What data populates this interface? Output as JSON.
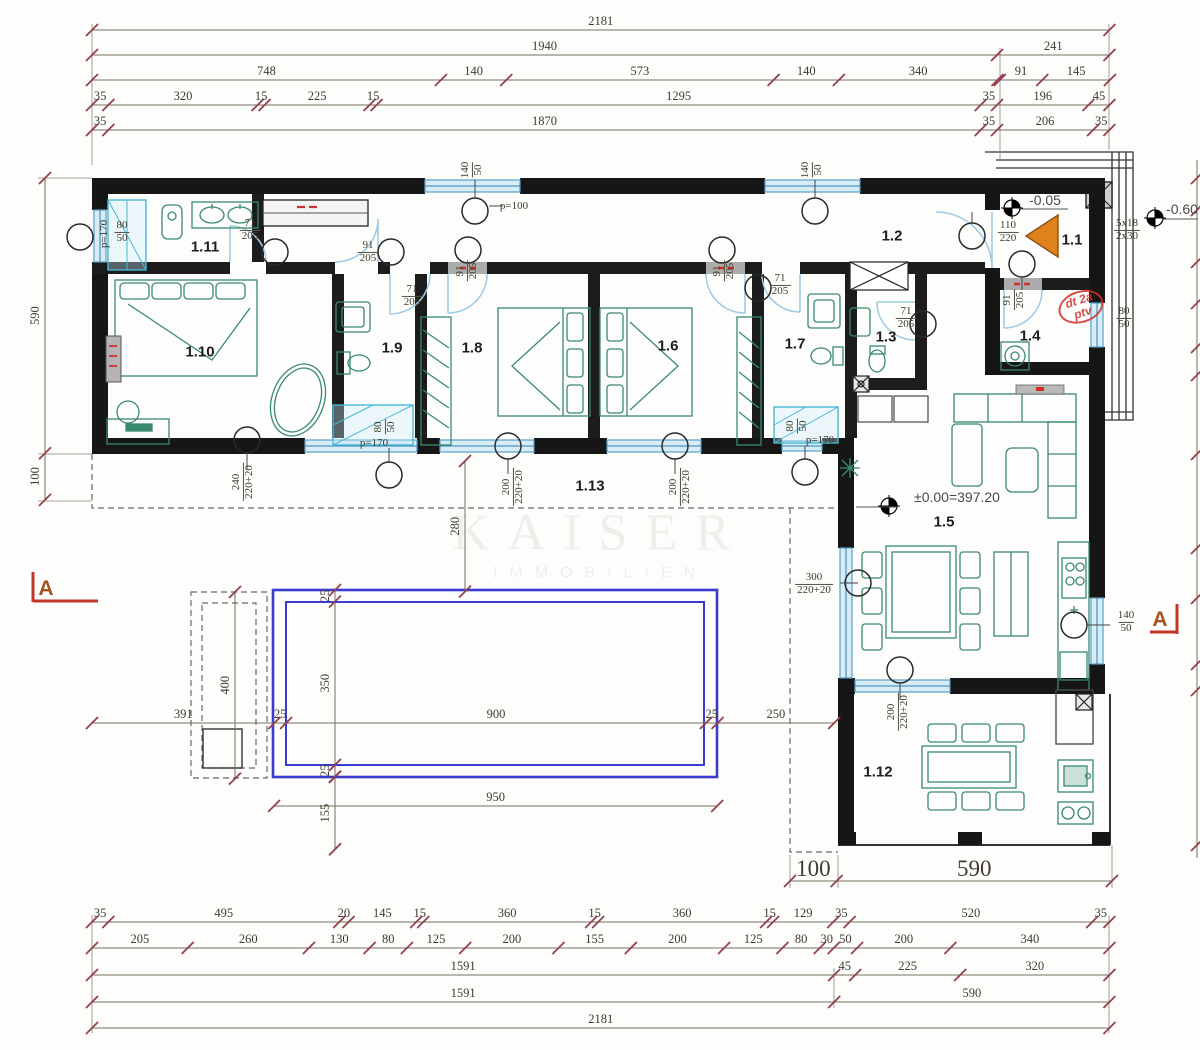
{
  "watermark": {
    "line1": "KAISER",
    "line2": "IMMOBILIEN"
  },
  "scale_px_per_cm": 0.4665,
  "colors": {
    "walls": "#161616",
    "dim_line": "#75705c",
    "dim_tick": "#93404a",
    "dim_text": "#3f3b2d",
    "window": "#5aa0c8",
    "window_fill": "#d6ecf7",
    "door_arc": "#9fcbe4",
    "furniture": "#3a8a6e",
    "pool": "#3b3bd1",
    "red_note": "#d03028",
    "orange_arrow": "#e0821c"
  },
  "rooms": [
    {
      "label": "1.1",
      "x": 1072,
      "y": 240
    },
    {
      "label": "1.2",
      "x": 892,
      "y": 236
    },
    {
      "label": "1.3",
      "x": 886,
      "y": 337
    },
    {
      "label": "1.4",
      "x": 1030,
      "y": 336
    },
    {
      "label": "1.5",
      "x": 944,
      "y": 522
    },
    {
      "label": "1.6",
      "x": 668,
      "y": 346
    },
    {
      "label": "1.7",
      "x": 795,
      "y": 344
    },
    {
      "label": "1.8",
      "x": 472,
      "y": 348
    },
    {
      "label": "1.9",
      "x": 392,
      "y": 348
    },
    {
      "label": "1.10",
      "x": 200,
      "y": 352
    },
    {
      "label": "1.11",
      "x": 205,
      "y": 247
    },
    {
      "label": "1.12",
      "x": 878,
      "y": 772
    },
    {
      "label": "1.13",
      "x": 590,
      "y": 486
    }
  ],
  "door_window_tags": [
    {
      "top": "71",
      "bottom": "205",
      "x": 250,
      "y": 230,
      "rot": 0
    },
    {
      "top": "91",
      "bottom": "205",
      "x": 368,
      "y": 252,
      "rot": 0
    },
    {
      "top": "71",
      "bottom": "205",
      "x": 412,
      "y": 296,
      "rot": 0
    },
    {
      "top": "91",
      "bottom": "205",
      "x": 467,
      "y": 271,
      "rot": -90
    },
    {
      "top": "91",
      "bottom": "205",
      "x": 724,
      "y": 271,
      "rot": -90
    },
    {
      "top": "71",
      "bottom": "205",
      "x": 780,
      "y": 285,
      "rot": 0
    },
    {
      "top": "71",
      "bottom": "205",
      "x": 906,
      "y": 318,
      "rot": 0
    },
    {
      "top": "91",
      "bottom": "205",
      "x": 1014,
      "y": 300,
      "rot": -90
    },
    {
      "top": "110",
      "bottom": "220",
      "x": 1008,
      "y": 232,
      "rot": 0
    },
    {
      "top": "80",
      "bottom": "50",
      "x": 122,
      "y": 232,
      "rot": 0
    },
    {
      "top": "140",
      "bottom": "50",
      "x": 472,
      "y": 170,
      "rot": -90
    },
    {
      "top": "140",
      "bottom": "50",
      "x": 812,
      "y": 170,
      "rot": -90
    },
    {
      "top": "80",
      "bottom": "50",
      "x": 385,
      "y": 427,
      "rot": -90
    },
    {
      "top": "80",
      "bottom": "50",
      "x": 797,
      "y": 426,
      "rot": -90
    },
    {
      "top": "240",
      "bottom": "220+20",
      "x": 243,
      "y": 482,
      "rot": -90
    },
    {
      "top": "200",
      "bottom": "220+20",
      "x": 513,
      "y": 487,
      "rot": -90
    },
    {
      "top": "200",
      "bottom": "220+20",
      "x": 680,
      "y": 487,
      "rot": -90
    },
    {
      "top": "200",
      "bottom": "220+20",
      "x": 898,
      "y": 712,
      "rot": -90
    },
    {
      "top": "300",
      "bottom": "220+20",
      "x": 814,
      "y": 584,
      "rot": 0
    },
    {
      "top": "80",
      "bottom": "50",
      "x": 1124,
      "y": 318,
      "rot": 0
    },
    {
      "top": "140",
      "bottom": "50",
      "x": 1126,
      "y": 622,
      "rot": 0
    },
    {
      "top": "5x18",
      "bottom": "2x30",
      "x": 1127,
      "y": 230,
      "rot": 0
    }
  ],
  "notes": [
    {
      "text": "p=100",
      "x": 514,
      "y": 206,
      "rot": 0
    },
    {
      "text": "p=170",
      "x": 104,
      "y": 234,
      "rot": -90
    },
    {
      "text": "p=170",
      "x": 374,
      "y": 443,
      "rot": 0
    },
    {
      "text": "p=170",
      "x": 820,
      "y": 440,
      "rot": 0
    }
  ],
  "levels": [
    {
      "text": "-0.05",
      "x": 1045,
      "y": 200
    },
    {
      "text": "-0.60",
      "x": 1182,
      "y": 209
    },
    {
      "text": "±0.00=397.20",
      "x": 957,
      "y": 497
    }
  ],
  "red_stamp": {
    "line1": "dt 2a",
    "line2": "ptv"
  },
  "section_markers": [
    {
      "label": "A",
      "x": 46,
      "y": 589
    },
    {
      "label": "A",
      "x": 1160,
      "y": 620
    }
  ],
  "dim_chains": [
    {
      "id": "top-1",
      "orient": "h",
      "x": 92,
      "y": 30,
      "fs": 12.5,
      "segments": [
        {
          "cm": 2181,
          "label": "2181"
        }
      ]
    },
    {
      "id": "top-2",
      "orient": "h",
      "x": 92,
      "y": 55,
      "fs": 12.5,
      "segments": [
        {
          "cm": 1940,
          "label": "1940"
        },
        {
          "cm": 241,
          "label": "241"
        }
      ]
    },
    {
      "id": "top-3",
      "orient": "h",
      "x": 92,
      "y": 80,
      "fs": 12.5,
      "segments": [
        {
          "cm": 748,
          "label": "748"
        },
        {
          "cm": 140,
          "label": "140"
        },
        {
          "cm": 573,
          "label": "573"
        },
        {
          "cm": 140,
          "label": "140"
        },
        {
          "cm": 340,
          "label": "340"
        },
        {
          "cm": 5,
          "label": ""
        },
        {
          "cm": 91,
          "label": "91"
        },
        {
          "cm": 145,
          "label": "145"
        }
      ]
    },
    {
      "id": "top-4",
      "orient": "h",
      "x": 92,
      "y": 105,
      "fs": 12.5,
      "segments": [
        {
          "cm": 35,
          "label": "35"
        },
        {
          "cm": 320,
          "label": "320"
        },
        {
          "cm": 15,
          "label": "15"
        },
        {
          "cm": 225,
          "label": "225"
        },
        {
          "cm": 15,
          "label": "15"
        },
        {
          "cm": 1295,
          "label": "1295"
        },
        {
          "cm": 35,
          "label": "35"
        },
        {
          "cm": 196,
          "label": "196"
        },
        {
          "cm": 45,
          "label": "45"
        }
      ]
    },
    {
      "id": "top-5",
      "orient": "h",
      "x": 92,
      "y": 130,
      "fs": 12.5,
      "segments": [
        {
          "cm": 35,
          "label": "35"
        },
        {
          "cm": 1870,
          "label": "1870"
        },
        {
          "cm": 35,
          "label": "35"
        },
        {
          "cm": 206,
          "label": "206"
        },
        {
          "cm": 35,
          "label": "35"
        }
      ]
    },
    {
      "id": "bottom-1",
      "orient": "h",
      "x": 92,
      "y": 922,
      "fs": 12.5,
      "segments": [
        {
          "cm": 35,
          "label": "35"
        },
        {
          "cm": 495,
          "label": "495"
        },
        {
          "cm": 20,
          "label": "20"
        },
        {
          "cm": 145,
          "label": "145"
        },
        {
          "cm": 15,
          "label": "15"
        },
        {
          "cm": 360,
          "label": "360"
        },
        {
          "cm": 15,
          "label": "15"
        },
        {
          "cm": 360,
          "label": "360"
        },
        {
          "cm": 15,
          "label": "15"
        },
        {
          "cm": 129,
          "label": "129"
        },
        {
          "cm": 35,
          "label": "35"
        },
        {
          "cm": 520,
          "label": "520"
        },
        {
          "cm": 37,
          "label": "35"
        }
      ]
    },
    {
      "id": "bottom-2",
      "orient": "h",
      "x": 92,
      "y": 948,
      "fs": 12.5,
      "segments": [
        {
          "cm": 205,
          "label": "205"
        },
        {
          "cm": 260,
          "label": "260"
        },
        {
          "cm": 130,
          "label": "130"
        },
        {
          "cm": 80,
          "label": "80"
        },
        {
          "cm": 125,
          "label": "125"
        },
        {
          "cm": 200,
          "label": "200"
        },
        {
          "cm": 155,
          "label": "155"
        },
        {
          "cm": 200,
          "label": "200"
        },
        {
          "cm": 125,
          "label": "125"
        },
        {
          "cm": 80,
          "label": "80"
        },
        {
          "cm": 30,
          "label": "30"
        },
        {
          "cm": 50,
          "label": "50"
        },
        {
          "cm": 200,
          "label": "200"
        },
        {
          "cm": 341,
          "label": "340"
        }
      ]
    },
    {
      "id": "bottom-3",
      "orient": "h",
      "x": 92,
      "y": 975,
      "fs": 12.5,
      "segments": [
        {
          "cm": 1591,
          "label": "1591"
        },
        {
          "cm": 45,
          "label": "45"
        },
        {
          "cm": 225,
          "label": "225"
        },
        {
          "cm": 320,
          "label": "320"
        }
      ]
    },
    {
      "id": "bottom-4",
      "orient": "h",
      "x": 92,
      "y": 1002,
      "fs": 12.5,
      "segments": [
        {
          "cm": 1591,
          "label": "1591"
        },
        {
          "cm": 590,
          "label": "590"
        }
      ]
    },
    {
      "id": "bottom-5",
      "orient": "h",
      "x": 92,
      "y": 1028,
      "fs": 12.5,
      "segments": [
        {
          "cm": 2181,
          "label": "2181"
        }
      ]
    },
    {
      "id": "left-v",
      "orient": "v",
      "x": 45,
      "y": 178,
      "fs": 12.5,
      "segments": [
        {
          "cm": 590,
          "label": "590"
        },
        {
          "cm": 100,
          "label": "100"
        }
      ]
    },
    {
      "id": "terrace-big",
      "orient": "h",
      "x": 790,
      "y": 881,
      "fs": 23,
      "segments": [
        {
          "cm": 100,
          "label": "100"
        },
        {
          "cm": 590,
          "label": "590"
        }
      ]
    },
    {
      "id": "pool-h",
      "orient": "h",
      "x": 92,
      "y": 723,
      "fs": 12.5,
      "segments": [
        {
          "cm": 391,
          "label": "391"
        },
        {
          "cm": 25,
          "label": "25"
        },
        {
          "cm": 900,
          "label": "900"
        },
        {
          "cm": 25,
          "label": "25"
        },
        {
          "cm": 250,
          "label": "250"
        }
      ]
    },
    {
      "id": "pool-950",
      "orient": "h",
      "x": 274,
      "y": 806,
      "fs": 12.5,
      "segments": [
        {
          "cm": 950,
          "label": "950"
        }
      ]
    },
    {
      "id": "pool-400",
      "orient": "v",
      "x": 235,
      "y": 592,
      "fs": 12.5,
      "segments": [
        {
          "cm": 400,
          "label": "400"
        }
      ]
    },
    {
      "id": "pool-350",
      "orient": "v",
      "x": 335,
      "y": 590,
      "fs": 12.5,
      "segments": [
        {
          "cm": 25,
          "label": "25"
        },
        {
          "cm": 350,
          "label": "350"
        },
        {
          "cm": 25,
          "label": "25"
        }
      ]
    },
    {
      "id": "pool-155",
      "orient": "v",
      "x": 335,
      "y": 777,
      "fs": 12.5,
      "segments": [
        {
          "cm": 155,
          "label": "155"
        }
      ]
    },
    {
      "id": "terrace-280",
      "orient": "v",
      "x": 465,
      "y": 461,
      "fs": 12.5,
      "segments": [
        {
          "cm": 280,
          "label": "280"
        }
      ]
    }
  ]
}
